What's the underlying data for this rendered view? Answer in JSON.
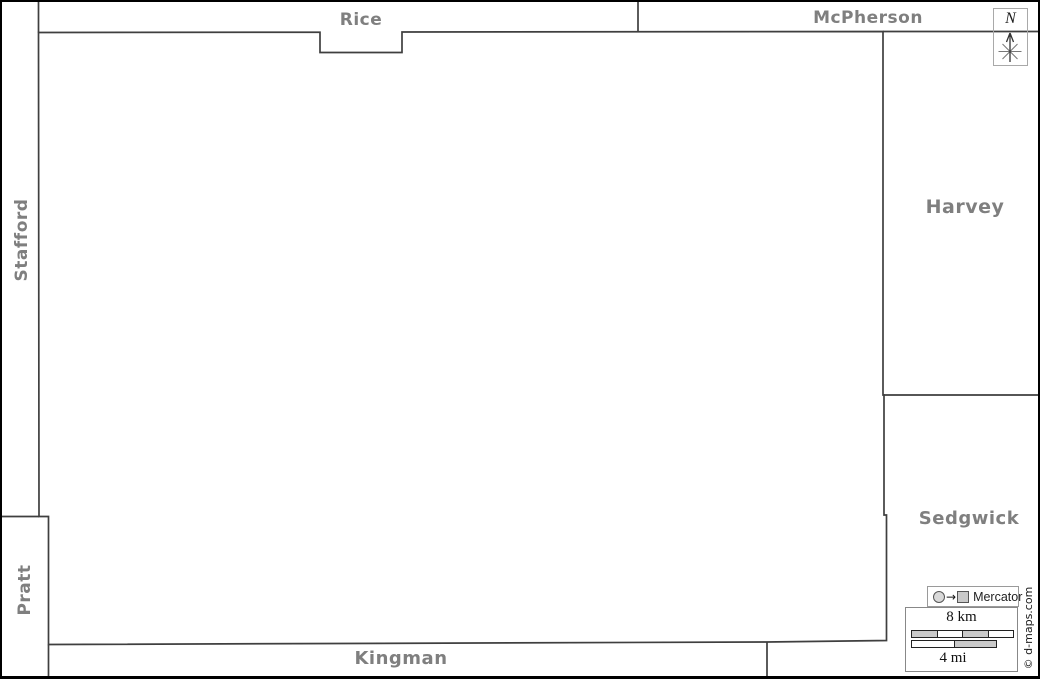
{
  "regions": {
    "rice": "Rice",
    "mcpherson": "McPherson",
    "stafford": "Stafford",
    "pratt": "Pratt",
    "harvey": "Harvey",
    "sedgwick": "Sedgwick",
    "kingman": "Kingman"
  },
  "compass": {
    "north": "N"
  },
  "projection_legend": {
    "arrow": "→",
    "label": "Mercator"
  },
  "scale_bar": {
    "km": "8 km",
    "mi": "4 mi"
  },
  "credit": "© d-maps.com",
  "colors": {
    "region_label": "#7f7f7f",
    "boundary": "#3f3f3f",
    "scale_fill": "#c9c9c9",
    "frame": "#000000"
  }
}
